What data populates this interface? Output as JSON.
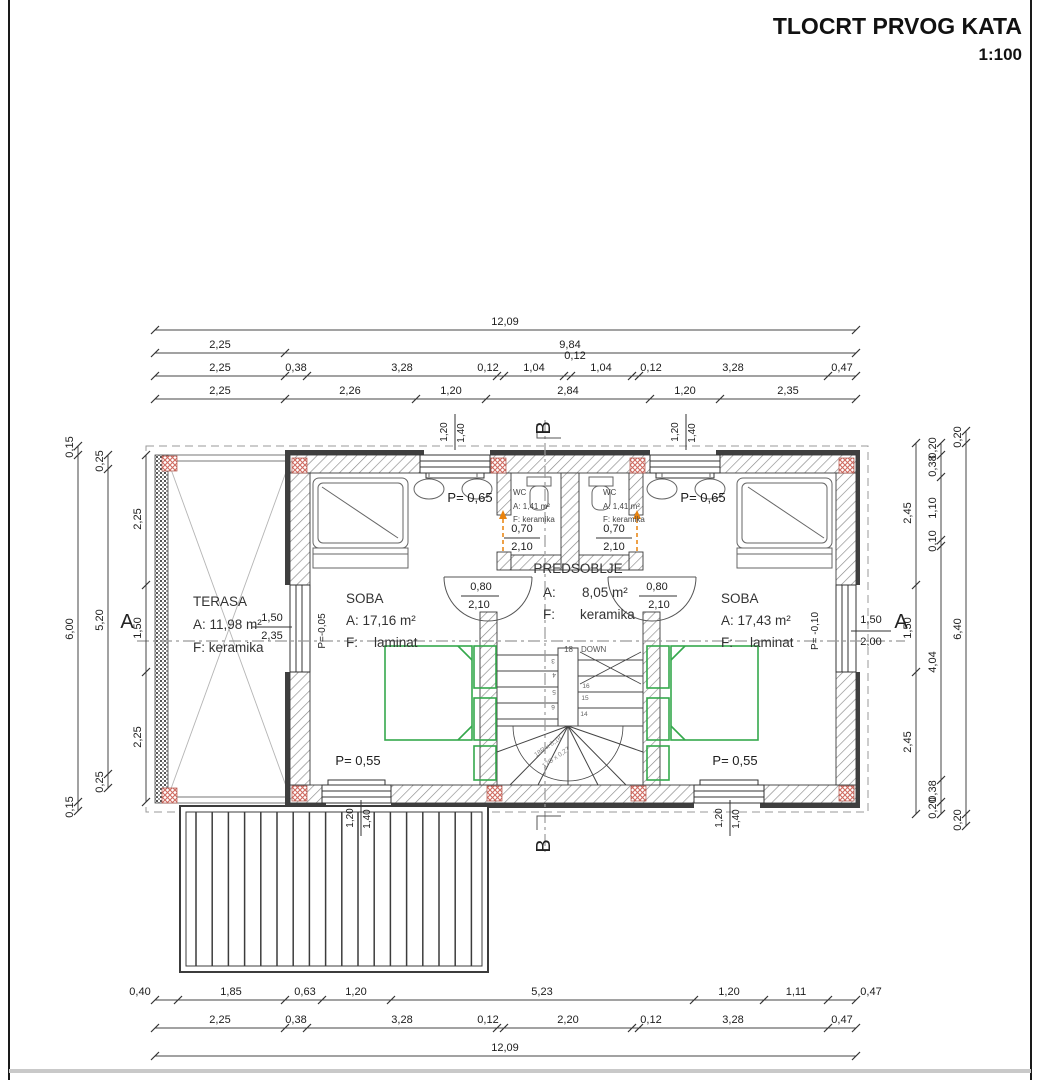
{
  "title": {
    "text": "TLOCRT PRVOG KATA",
    "scale": "1:100"
  },
  "section_markers": {
    "a_left": "A",
    "a_right": "A",
    "b_top": "B",
    "b_bottom": "B"
  },
  "rooms": {
    "terasa": {
      "name": "TERASA",
      "area": "A: 11,98 m²",
      "floor": "F: keramika"
    },
    "soba_left": {
      "name": "SOBA",
      "area": "A: 17,16 m²",
      "floor_label": "F:",
      "floor": "laminat"
    },
    "soba_right": {
      "name": "SOBA",
      "area": "A: 17,43 m²",
      "floor_label": "F:",
      "floor": "laminat"
    },
    "predsoblje": {
      "name": "PREDSOBLJE",
      "area_label": "A:",
      "area": "8,05 m²",
      "floor_label": "F:",
      "floor": "keramika"
    },
    "wc_left": {
      "name": "WC",
      "area": "A: 1,41 m²",
      "floor": "F: keramika"
    },
    "wc_right": {
      "name": "WC",
      "area": "A: 1,41 m²",
      "floor": "F: keramika"
    }
  },
  "stairs": {
    "count_label": "18",
    "down_label": "DOWN",
    "riser_note": "18R x 0,18",
    "going_note": "17G x 0,27",
    "left_step_numbers": [
      "3",
      "4",
      "5",
      "6"
    ],
    "right_step_numbers": [
      "16",
      "15",
      "14"
    ]
  },
  "dim_chains": [
    {
      "o": "h",
      "p": 330,
      "b": [
        155,
        856
      ],
      "labels": [
        {
          "x": 505,
          "t": "12,09"
        }
      ]
    },
    {
      "o": "h",
      "p": 353,
      "b": [
        155,
        285,
        856
      ],
      "labels": [
        {
          "x": 220,
          "t": "2,25"
        },
        {
          "x": 570,
          "t": "9,84"
        }
      ]
    },
    {
      "o": "h",
      "p": 376,
      "b": [
        155,
        285,
        307,
        497,
        504,
        564,
        571,
        632,
        639,
        828,
        856
      ],
      "labels": [
        {
          "x": 220,
          "t": "2,25"
        },
        {
          "x": 296,
          "t": "0,38"
        },
        {
          "x": 402,
          "t": "3,28"
        },
        {
          "x": 488,
          "t": "0,12"
        },
        {
          "x": 534,
          "t": "1,04"
        },
        {
          "x": 575,
          "t": "0,12",
          "dy": -12
        },
        {
          "x": 601,
          "t": "1,04"
        },
        {
          "x": 651,
          "t": "0,12"
        },
        {
          "x": 733,
          "t": "3,28"
        },
        {
          "x": 842,
          "t": "0,47"
        }
      ]
    },
    {
      "o": "h",
      "p": 399,
      "b": [
        155,
        285,
        416,
        486,
        650,
        720,
        856
      ],
      "labels": [
        {
          "x": 220,
          "t": "2,25"
        },
        {
          "x": 350,
          "t": "2,26"
        },
        {
          "x": 451,
          "t": "1,20"
        },
        {
          "x": 568,
          "t": "2,84"
        },
        {
          "x": 685,
          "t": "1,20"
        },
        {
          "x": 788,
          "t": "2,35"
        }
      ]
    },
    {
      "o": "h",
      "p": 1000,
      "b": [
        155,
        178,
        285,
        322,
        391,
        694,
        764,
        828,
        856
      ],
      "labels": [
        {
          "x": 140,
          "t": "0,40"
        },
        {
          "x": 231,
          "t": "1,85"
        },
        {
          "x": 305,
          "t": "0,63"
        },
        {
          "x": 356,
          "t": "1,20"
        },
        {
          "x": 542,
          "t": "5,23"
        },
        {
          "x": 729,
          "t": "1,20"
        },
        {
          "x": 796,
          "t": "1,11"
        },
        {
          "x": 871,
          "t": "0,47"
        }
      ]
    },
    {
      "o": "h",
      "p": 1028,
      "b": [
        155,
        285,
        307,
        497,
        504,
        632,
        639,
        828,
        856
      ],
      "labels": [
        {
          "x": 220,
          "t": "2,25"
        },
        {
          "x": 296,
          "t": "0,38"
        },
        {
          "x": 402,
          "t": "3,28"
        },
        {
          "x": 488,
          "t": "0,12"
        },
        {
          "x": 568,
          "t": "2,20"
        },
        {
          "x": 651,
          "t": "0,12"
        },
        {
          "x": 733,
          "t": "3,28"
        },
        {
          "x": 842,
          "t": "0,47"
        }
      ]
    },
    {
      "o": "h",
      "p": 1056,
      "b": [
        155,
        856
      ],
      "labels": [
        {
          "x": 505,
          "t": "12,09"
        }
      ]
    },
    {
      "o": "v",
      "p": 78,
      "b": [
        446,
        455,
        802,
        811
      ],
      "labels": [
        {
          "y": 447,
          "t": "0,15"
        },
        {
          "y": 629,
          "t": "6,00"
        },
        {
          "y": 807,
          "t": "0,15"
        }
      ]
    },
    {
      "o": "v",
      "p": 108,
      "b": [
        455,
        469,
        774,
        788
      ],
      "labels": [
        {
          "y": 461,
          "t": "0,25"
        },
        {
          "y": 620,
          "t": "5,20"
        },
        {
          "y": 782,
          "t": "0,25"
        }
      ]
    },
    {
      "o": "v",
      "p": 146,
      "b": [
        455,
        585,
        672,
        802
      ],
      "labels": [
        {
          "y": 519,
          "t": "2,25"
        },
        {
          "y": 628,
          "t": "1,50"
        },
        {
          "y": 737,
          "t": "2,25"
        }
      ]
    },
    {
      "o": "v",
      "p": 916,
      "b": [
        443,
        585,
        672,
        814
      ],
      "labels": [
        {
          "y": 513,
          "t": "2,45"
        },
        {
          "y": 628,
          "t": "1,50"
        },
        {
          "y": 742,
          "t": "2,45"
        }
      ]
    },
    {
      "o": "v",
      "p": 941,
      "b": [
        443,
        455,
        477,
        540,
        546,
        780,
        802,
        814
      ],
      "labels": [
        {
          "y": 448,
          "t": "0,20"
        },
        {
          "y": 466,
          "t": "0,38"
        },
        {
          "y": 508,
          "t": "1,10"
        },
        {
          "y": 541,
          "t": "0,10"
        },
        {
          "y": 662,
          "t": "4,04"
        },
        {
          "y": 791,
          "t": "0,38"
        },
        {
          "y": 808,
          "t": "0,20"
        }
      ]
    },
    {
      "o": "v",
      "p": 966,
      "b": [
        431,
        443,
        814,
        826
      ],
      "labels": [
        {
          "y": 437,
          "t": "0,20"
        },
        {
          "y": 629,
          "t": "6,40"
        },
        {
          "y": 820,
          "t": "0,20"
        }
      ]
    }
  ],
  "point_labels": [
    {
      "x": 272,
      "y": 621,
      "t": "1,50"
    },
    {
      "x": 272,
      "y": 639,
      "t": "2,35"
    },
    {
      "x": 325,
      "y": 631,
      "t": "P=-0,05",
      "r": -90,
      "fs": 10
    },
    {
      "x": 871,
      "y": 623,
      "t": "1,50"
    },
    {
      "x": 871,
      "y": 645,
      "t": "2,00"
    },
    {
      "x": 818,
      "y": 631,
      "t": "P= -0,10",
      "r": -90,
      "fs": 10
    },
    {
      "x": 447,
      "y": 432,
      "t": "1,20",
      "r": -90,
      "fs": 10
    },
    {
      "x": 464,
      "y": 433,
      "t": "1,40",
      "r": -90,
      "fs": 10
    },
    {
      "x": 678,
      "y": 432,
      "t": "1,20",
      "r": -90,
      "fs": 10
    },
    {
      "x": 695,
      "y": 433,
      "t": "1,40",
      "r": -90,
      "fs": 10
    },
    {
      "x": 353,
      "y": 818,
      "t": "1,20",
      "r": -90,
      "fs": 10
    },
    {
      "x": 370,
      "y": 819,
      "t": "1,40",
      "r": -90,
      "fs": 10
    },
    {
      "x": 722,
      "y": 818,
      "t": "1,20",
      "r": -90,
      "fs": 10
    },
    {
      "x": 739,
      "y": 819,
      "t": "1,40",
      "r": -90,
      "fs": 10
    },
    {
      "x": 470,
      "y": 502,
      "t": "P= 0,65",
      "fs": 13
    },
    {
      "x": 703,
      "y": 502,
      "t": "P= 0,65",
      "fs": 13
    },
    {
      "x": 358,
      "y": 765,
      "t": "P= 0,55",
      "fs": 13
    },
    {
      "x": 735,
      "y": 765,
      "t": "P= 0,55",
      "fs": 13
    },
    {
      "x": 522,
      "y": 532,
      "t": "0,70"
    },
    {
      "x": 522,
      "y": 550,
      "t": "2,10"
    },
    {
      "x": 614,
      "y": 532,
      "t": "0,70"
    },
    {
      "x": 614,
      "y": 550,
      "t": "2,10"
    },
    {
      "x": 481,
      "y": 590,
      "t": "0,80"
    },
    {
      "x": 479,
      "y": 608,
      "t": "2,10"
    },
    {
      "x": 657,
      "y": 590,
      "t": "0,80"
    },
    {
      "x": 659,
      "y": 608,
      "t": "2,10"
    }
  ],
  "colors": {
    "accent_orange": "#e8820c",
    "furniture_green": "#35a84c",
    "corner_red": "#cf6a60",
    "dash_gray": "#999999"
  }
}
